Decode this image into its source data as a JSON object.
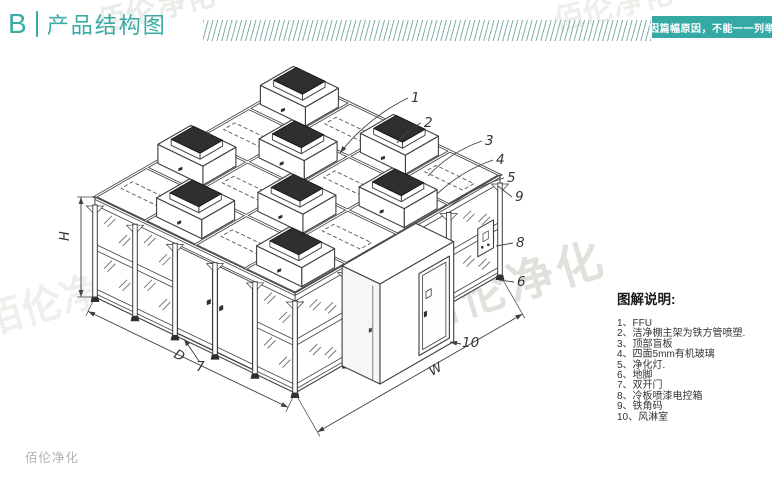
{
  "header": {
    "section_letter": "B",
    "title": "产品结构图",
    "badge": "因篇幅原因，不能一一列举"
  },
  "colors": {
    "accent": "#3aaca6",
    "badge_bg": "#35a9a3",
    "line": "#3f3f3f",
    "hatch": "#84adaa",
    "watermark": "#c9cfc2"
  },
  "diagram": {
    "dimension_labels": {
      "height": "H",
      "depth": "D",
      "width": "W"
    },
    "callout_numbers": [
      "1",
      "2",
      "3",
      "4",
      "5",
      "6",
      "7",
      "8",
      "9",
      "10"
    ]
  },
  "legend": {
    "title": "图解说明:",
    "items": [
      {
        "num": "1",
        "text": "FFU"
      },
      {
        "num": "2",
        "text": "洁净棚主架为铁方管喷塑."
      },
      {
        "num": "3",
        "text": "顶部盲板"
      },
      {
        "num": "4",
        "text": "四面5mm有机玻璃"
      },
      {
        "num": "5",
        "text": "净化灯."
      },
      {
        "num": "6",
        "text": "地脚"
      },
      {
        "num": "7",
        "text": "双开门"
      },
      {
        "num": "8",
        "text": "冷板喷漆电控箱"
      },
      {
        "num": "9",
        "text": "铁角码"
      },
      {
        "num": "10",
        "text": "风淋室"
      }
    ]
  },
  "watermarks": {
    "full": "佰伦净化"
  },
  "footer": {
    "logo_text": "佰伦净化"
  }
}
